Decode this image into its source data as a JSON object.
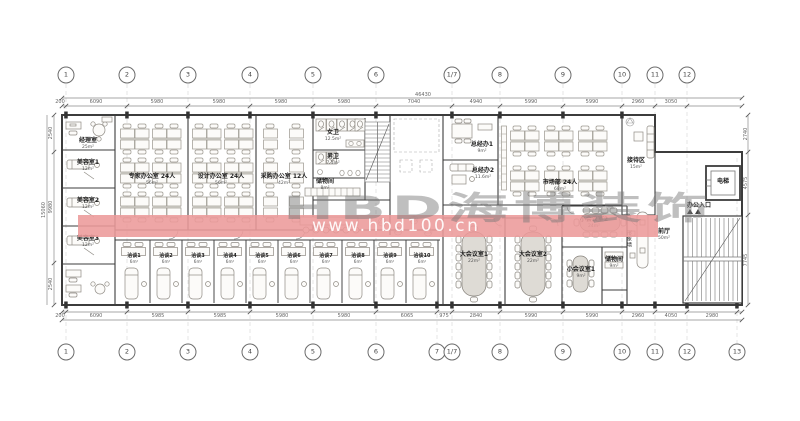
{
  "watermark": {
    "brand": "HBD海博装饰",
    "url": "www.hbd100.cn",
    "band_color": "rgba(236,154,154,0.88)"
  },
  "grid": {
    "top": [
      {
        "label": "1",
        "x": 66
      },
      {
        "label": "2",
        "x": 127
      },
      {
        "label": "3",
        "x": 188
      },
      {
        "label": "4",
        "x": 250
      },
      {
        "label": "5",
        "x": 313
      },
      {
        "label": "6",
        "x": 376
      },
      {
        "label": "1/7",
        "x": 452
      },
      {
        "label": "8",
        "x": 500
      },
      {
        "label": "9",
        "x": 563
      },
      {
        "label": "10",
        "x": 622
      },
      {
        "label": "11",
        "x": 655
      },
      {
        "label": "12",
        "x": 687
      }
    ],
    "bottom": [
      {
        "label": "1",
        "x": 66
      },
      {
        "label": "2",
        "x": 127
      },
      {
        "label": "3",
        "x": 188
      },
      {
        "label": "4",
        "x": 250
      },
      {
        "label": "5",
        "x": 313
      },
      {
        "label": "6",
        "x": 376
      },
      {
        "label": "7",
        "x": 437
      },
      {
        "label": "1/7",
        "x": 452
      },
      {
        "label": "8",
        "x": 500
      },
      {
        "label": "9",
        "x": 563
      },
      {
        "label": "10",
        "x": 622
      },
      {
        "label": "11",
        "x": 655
      },
      {
        "label": "12",
        "x": 687
      },
      {
        "label": "13",
        "x": 737
      }
    ]
  },
  "dimensions": {
    "overall_top": "46430",
    "left_overall": "15060",
    "top": [
      {
        "t": "200",
        "x": 60
      },
      {
        "t": "6090",
        "x": 96
      },
      {
        "t": "5980",
        "x": 157
      },
      {
        "t": "5980",
        "x": 219
      },
      {
        "t": "5980",
        "x": 281
      },
      {
        "t": "5980",
        "x": 344
      },
      {
        "t": "7040",
        "x": 414
      },
      {
        "t": "4940",
        "x": 476
      },
      {
        "t": "5990",
        "x": 531
      },
      {
        "t": "5990",
        "x": 592
      },
      {
        "t": "2960",
        "x": 638
      },
      {
        "t": "3050",
        "x": 671
      }
    ],
    "bottom": [
      {
        "t": "200",
        "x": 60
      },
      {
        "t": "6090",
        "x": 96
      },
      {
        "t": "5985",
        "x": 158
      },
      {
        "t": "5985",
        "x": 220
      },
      {
        "t": "5980",
        "x": 282
      },
      {
        "t": "5980",
        "x": 344
      },
      {
        "t": "6065",
        "x": 407
      },
      {
        "t": "975",
        "x": 444
      },
      {
        "t": "2840",
        "x": 476
      },
      {
        "t": "5990",
        "x": 531
      },
      {
        "t": "5990",
        "x": 592
      },
      {
        "t": "2960",
        "x": 638
      },
      {
        "t": "4050",
        "x": 671
      },
      {
        "t": "2980",
        "x": 712
      }
    ],
    "left": [
      {
        "t": "2540",
        "y": 133
      },
      {
        "t": "9980",
        "y": 207
      },
      {
        "t": "2540",
        "y": 284
      }
    ],
    "right": [
      {
        "t": "2740",
        "y": 134
      },
      {
        "t": "4575",
        "y": 183
      },
      {
        "t": "7745",
        "y": 260
      }
    ]
  },
  "rooms": [
    {
      "label": "经理室",
      "area": "25m²",
      "x": 88,
      "y": 138
    },
    {
      "label": "美容室1",
      "area": "12m²",
      "x": 88,
      "y": 160
    },
    {
      "label": "美容室2",
      "area": "12m²",
      "x": 88,
      "y": 198
    },
    {
      "label": "美容室3",
      "area": "12m²",
      "x": 88,
      "y": 236
    },
    {
      "label": "专家办公室 24人",
      "area": "56m²",
      "x": 152,
      "y": 174
    },
    {
      "label": "设计办公室 24人",
      "area": "56m²",
      "x": 221,
      "y": 174
    },
    {
      "label": "采购办公室 12人",
      "area": "42m²",
      "x": 284,
      "y": 174
    },
    {
      "label": "女卫",
      "area": "12.5m²",
      "x": 333,
      "y": 130
    },
    {
      "label": "男卫",
      "area": "7.5m²",
      "x": 333,
      "y": 154
    },
    {
      "label": "储物间",
      "area": "8m²",
      "x": 325,
      "y": 179
    },
    {
      "label": "总经办1",
      "area": "9m²",
      "x": 482,
      "y": 142
    },
    {
      "label": "总经办2",
      "area": "11.6m²",
      "x": 483,
      "y": 168
    },
    {
      "label": "市场部 24人",
      "area": "68m²",
      "x": 560,
      "y": 180
    },
    {
      "label": "接待区",
      "area": "15m²",
      "x": 636,
      "y": 158
    },
    {
      "label": "前厅",
      "area": "50m²",
      "x": 664,
      "y": 229
    },
    {
      "label": "电梯",
      "x": 723,
      "y": 179
    },
    {
      "label": "办公入口",
      "x": 699,
      "y": 203
    },
    {
      "label": "大会议室1",
      "area": "22m²",
      "x": 474,
      "y": 252
    },
    {
      "label": "大会议室2",
      "area": "22m²",
      "x": 533,
      "y": 252
    },
    {
      "label": "小会议室2",
      "area": "24m²",
      "x": 594,
      "y": 217
    },
    {
      "label": "小会议室1",
      "area": "9m²",
      "x": 581,
      "y": 267
    },
    {
      "label": "储物间",
      "area": "9m²",
      "x": 614,
      "y": 257
    }
  ],
  "consult_rooms": [
    {
      "label": "洽谈1",
      "area": "6m²",
      "x": 134
    },
    {
      "label": "洽谈2",
      "area": "6m²",
      "x": 166
    },
    {
      "label": "洽谈3",
      "area": "6m²",
      "x": 198
    },
    {
      "label": "洽谈4",
      "area": "6m²",
      "x": 230
    },
    {
      "label": "洽谈5",
      "area": "6m²",
      "x": 262
    },
    {
      "label": "洽谈6",
      "area": "6m²",
      "x": 294
    },
    {
      "label": "洽谈7",
      "area": "6m²",
      "x": 326
    },
    {
      "label": "洽谈8",
      "area": "6m²",
      "x": 358
    },
    {
      "label": "洽谈9",
      "area": "6m²",
      "x": 390
    },
    {
      "label": "洽谈10",
      "area": "6m²",
      "x": 422
    }
  ],
  "labels": {
    "feature_wall": "形象墙"
  }
}
